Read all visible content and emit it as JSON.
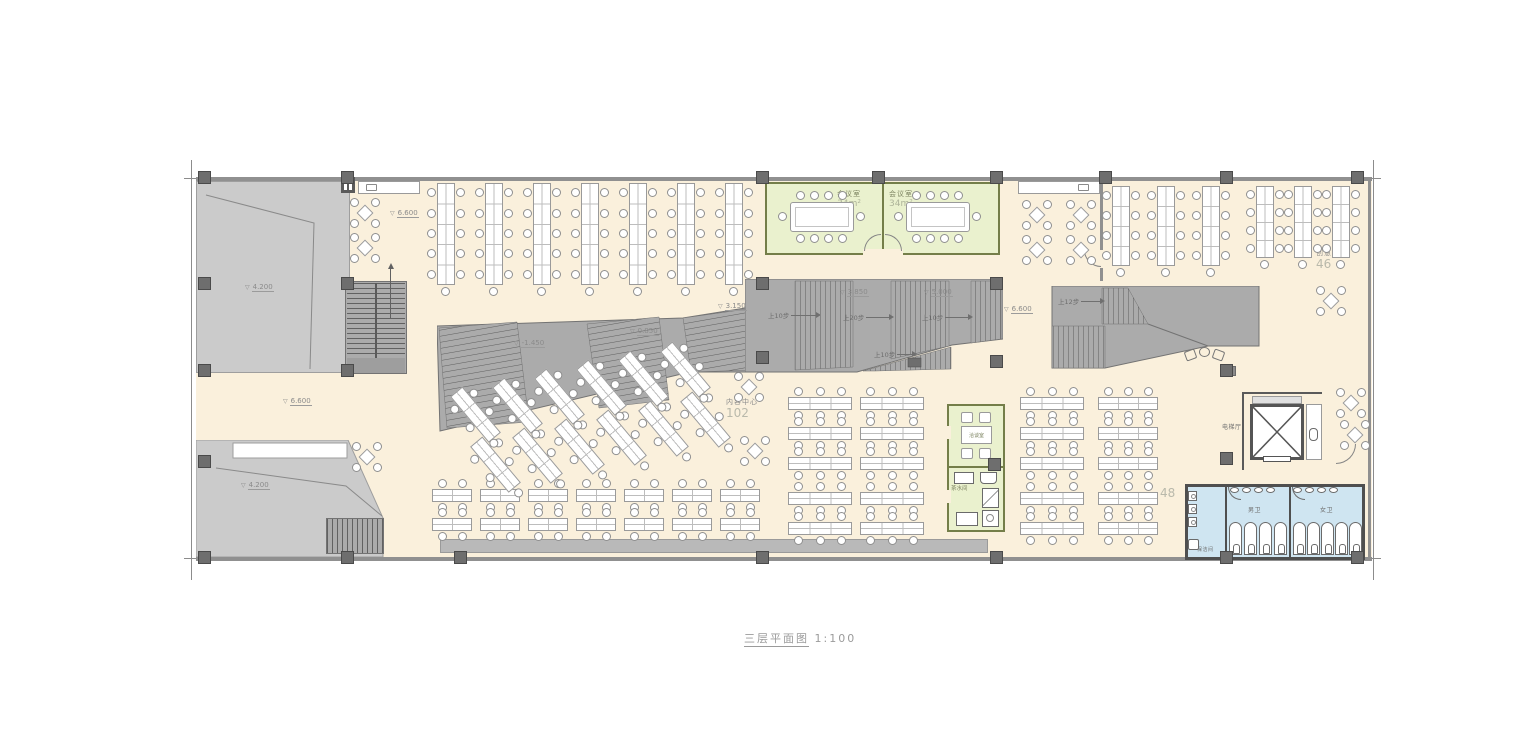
{
  "title": {
    "name": "三层平面图",
    "scale": "1:100"
  },
  "depts": {
    "tech": {
      "name": "技术部",
      "count": "70"
    },
    "content": {
      "name": "内容中心",
      "count": "102"
    },
    "creative": {
      "name": "创意部",
      "count": "46"
    },
    "zone": {
      "count": "48"
    }
  },
  "rooms": {
    "meeting": {
      "name": "会议室",
      "area": "34m²"
    },
    "negotiation": {
      "name": "洽谈室"
    },
    "pantry": {
      "name": "茶水间"
    },
    "elevator_hall": {
      "name": "电梯厅"
    },
    "mens": {
      "name": "男卫"
    },
    "womens": {
      "name": "女卫"
    },
    "janitor": {
      "name": "保洁间"
    }
  },
  "elevations": {
    "e6600": "6.600",
    "e4200": "4.200",
    "e3150": "3.150",
    "e0850": "0.850",
    "en1450": "-1.450",
    "e3850": "3.850",
    "e5000": "5.000"
  },
  "steps": {
    "up10": "上10步",
    "up20": "上20步",
    "up12": "上12步"
  },
  "colors": {
    "floor": "#FAF0DC",
    "void_gray": "#CBCBCB",
    "stair_gray": "#ABABAB",
    "meeting_green": "#EAF1CE",
    "green_border": "#747E49",
    "toilet_blue": "#CFE5F1",
    "wall": "#909090",
    "dark_wall": "#4F4F4F",
    "column": "#6E6E6E"
  }
}
